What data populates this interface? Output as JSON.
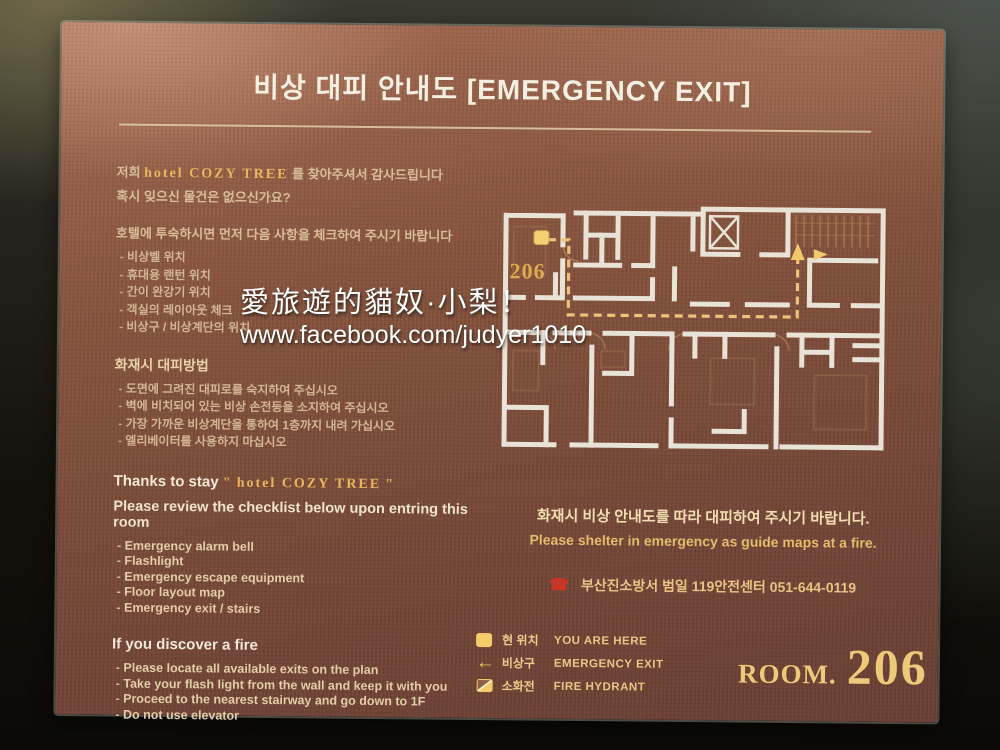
{
  "title": "비상 대피 안내도 [EMERGENCY EXIT]",
  "intro": {
    "greeting_prefix": "저희",
    "hotel_name": "hotel COZY TREE",
    "greeting_suffix": "를 찾아주셔서 감사드립니다",
    "lost_items": "혹시 잊으신 물건은 없으신가요?",
    "check_request": "호텔에 투숙하시면 먼저 다음 사항을 체크하여 주시기 바랍니다"
  },
  "checklist_kr": [
    "비상벨 위치",
    "휴대용 랜턴 위치",
    "간이 완강기 위치",
    "객실의 레이아웃 체크",
    "비상구 / 비상계단의 위치"
  ],
  "fire_section": {
    "heading": "화재시 대피방법",
    "items": [
      "도면에 그려진 대피로를 숙지하여 주십시오",
      "벽에 비치되어 있는 비상 손전등을 소지하여 주십시오",
      "가장 가까운 비상계단을 통하여 1층까지 내려 가십시오",
      "엘리베이터를 사용하지 마십시오"
    ]
  },
  "thanks": {
    "prefix": "Thanks to stay",
    "quote_open": "\"",
    "hotel_name": "hotel COZY TREE",
    "quote_close": "\"",
    "review": "Please review the checklist below upon entring this room"
  },
  "checklist_en": [
    "Emergency alarm bell",
    "Flashlight",
    "Emergency escape equipment",
    "Floor layout map",
    "Emergency exit / stairs"
  ],
  "discover": {
    "heading": "If you discover a fire",
    "items": [
      "Please locate all available exits on the plan",
      "Take your flash light from the wall and keep it with you",
      "Proceed to the nearest stairway and go down to 1F",
      "Do not use elevator"
    ]
  },
  "notice": {
    "kr": "화재시 비상 안내도를 따라 대피하여 주시기 바랍니다.",
    "en": "Please shelter in emergency as guide maps at a fire.",
    "phone_glyph": "☎",
    "phone_text": "부산진소방서 범일 119안전센터  051-644-0119"
  },
  "legend": [
    {
      "icon": "you-are-here-icon",
      "kr": "현 위치",
      "en": "YOU ARE HERE"
    },
    {
      "icon": "emergency-exit-icon",
      "kr": "비상구",
      "en": "EMERGENCY EXIT"
    },
    {
      "icon": "fire-hydrant-icon",
      "kr": "소화전",
      "en": "FIRE HYDRANT"
    }
  ],
  "room": {
    "label": "ROOM.",
    "number": "206"
  },
  "floor_plan": {
    "marker_label": "206"
  },
  "watermark": {
    "line1": "愛旅遊的貓奴·小梨！",
    "line2": "www.facebook.com/judyer1010"
  },
  "colors": {
    "plaque_brown": "#7d4c3c",
    "gold": "#e9b75a",
    "text_tan": "#d8bd97",
    "route_orange": "#efc27a",
    "marker_yellow": "#f4cd6a",
    "wall_white": "#e9e2d6",
    "phone_red": "#cc3526"
  }
}
